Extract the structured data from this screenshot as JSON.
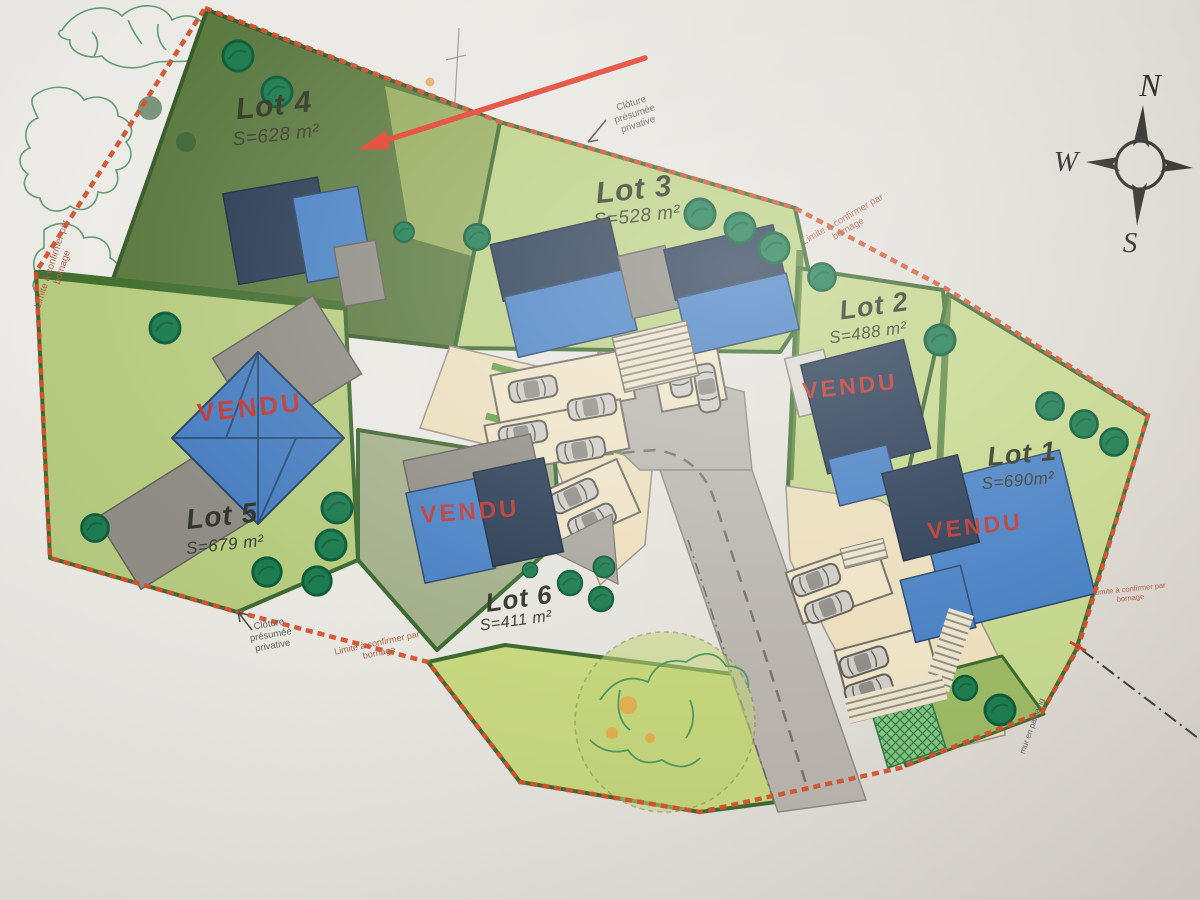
{
  "lots": [
    {
      "name": "Lot 1",
      "area": "S=690m²",
      "status": "VENDU"
    },
    {
      "name": "Lot 2",
      "area": "S=488 m²",
      "status": "VENDU"
    },
    {
      "name": "Lot 3",
      "area": "S=528 m²",
      "status": ""
    },
    {
      "name": "Lot 4",
      "area": "S=628 m²",
      "status": ""
    },
    {
      "name": "Lot 5",
      "area": "S=679 m²",
      "status": "VENDU"
    },
    {
      "name": "Lot 6",
      "area": "S=411 m²",
      "status": "VENDU"
    }
  ],
  "annotations": {
    "fence_private": "Clôture présumée privative",
    "boundary_confirm": "Limite à confirmer par bornage",
    "wall": "mur en parpaing"
  },
  "compass": {
    "north": "N",
    "west": "W",
    "south": "S"
  },
  "colors": {
    "sold_red": "#c9362c",
    "boundary_red": "#d5512d",
    "roof_blue": "#4a82c4",
    "roof_navy": "#2b3d55",
    "dark_lot_green": "#5d7a41",
    "light_lot_green": "#bcd084"
  }
}
